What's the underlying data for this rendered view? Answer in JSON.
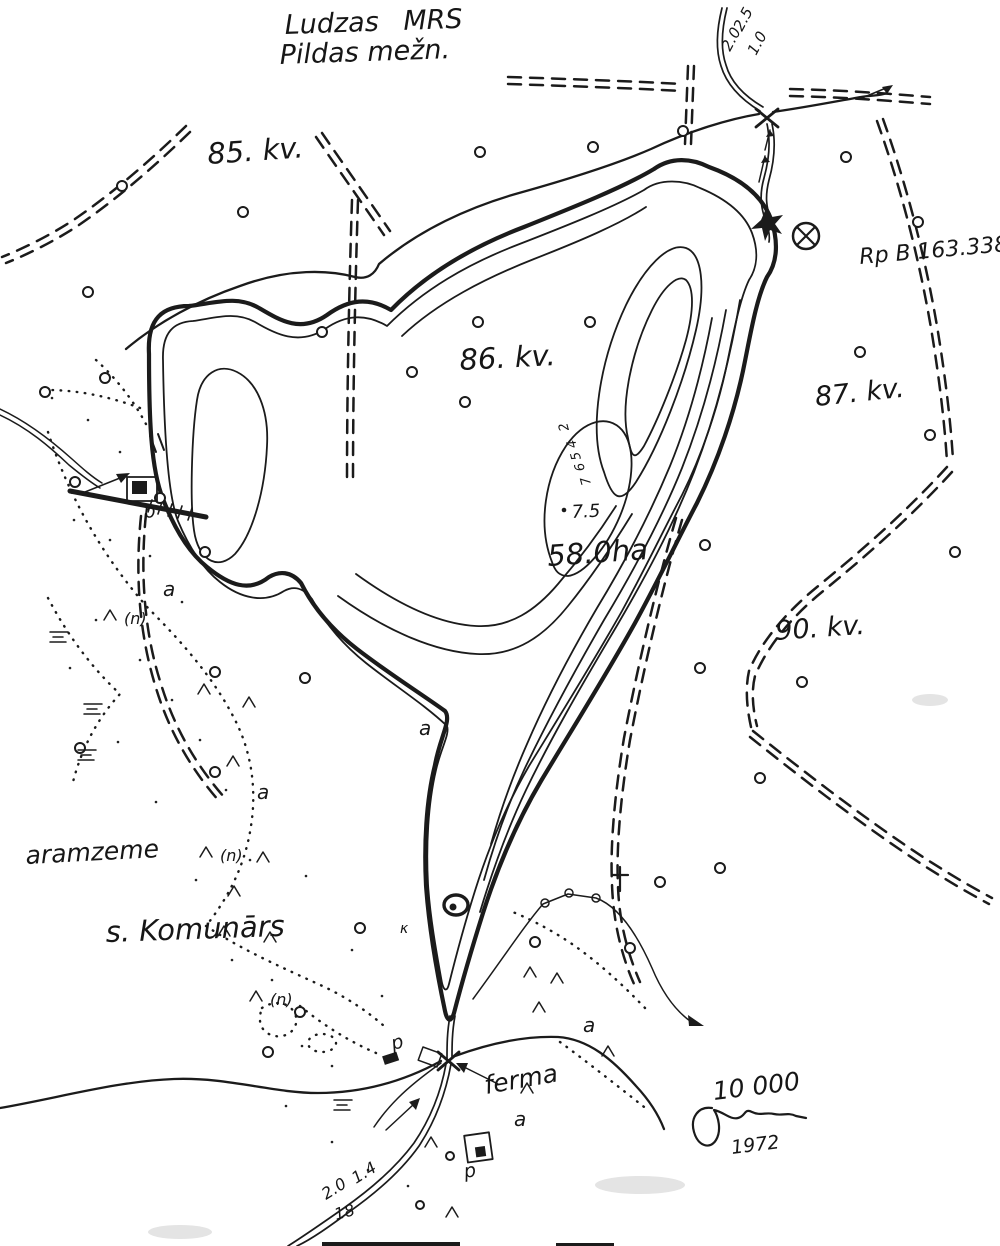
{
  "header": {
    "title_line1": "Ludzas MRS",
    "title_line2": "Pildas mežn."
  },
  "quarters": {
    "kv85": "85. kv.",
    "kv86": "86. kv.",
    "kv87": "87. kv.",
    "kv90": "90. kv."
  },
  "benchmark": {
    "label": "Rp B 163.338"
  },
  "lake": {
    "area_label": "58.0ha",
    "depth_point": "7.5",
    "contour_labels": {
      "c2": "2",
      "c4": "4",
      "c5": "5",
      "c6": "6",
      "c7": "7"
    }
  },
  "streams": {
    "top": {
      "width": "2.5",
      "depth": "1.0",
      "second": "2.0"
    },
    "bottom": {
      "width": "2.0",
      "depth": "1.4",
      "second": "18"
    }
  },
  "places": {
    "field_label": "aramzeme",
    "village": "s. Komunārs",
    "farm": "ferma"
  },
  "cartouche": {
    "scale": "10 000",
    "year": "1972"
  },
  "letters": {
    "p": "p",
    "a": "a",
    "n": "(n)",
    "kappa": "κ"
  },
  "symbols": {
    "cross": "†"
  },
  "colors": {
    "ink": "#1b1b1b",
    "paper": "#ffffff"
  }
}
